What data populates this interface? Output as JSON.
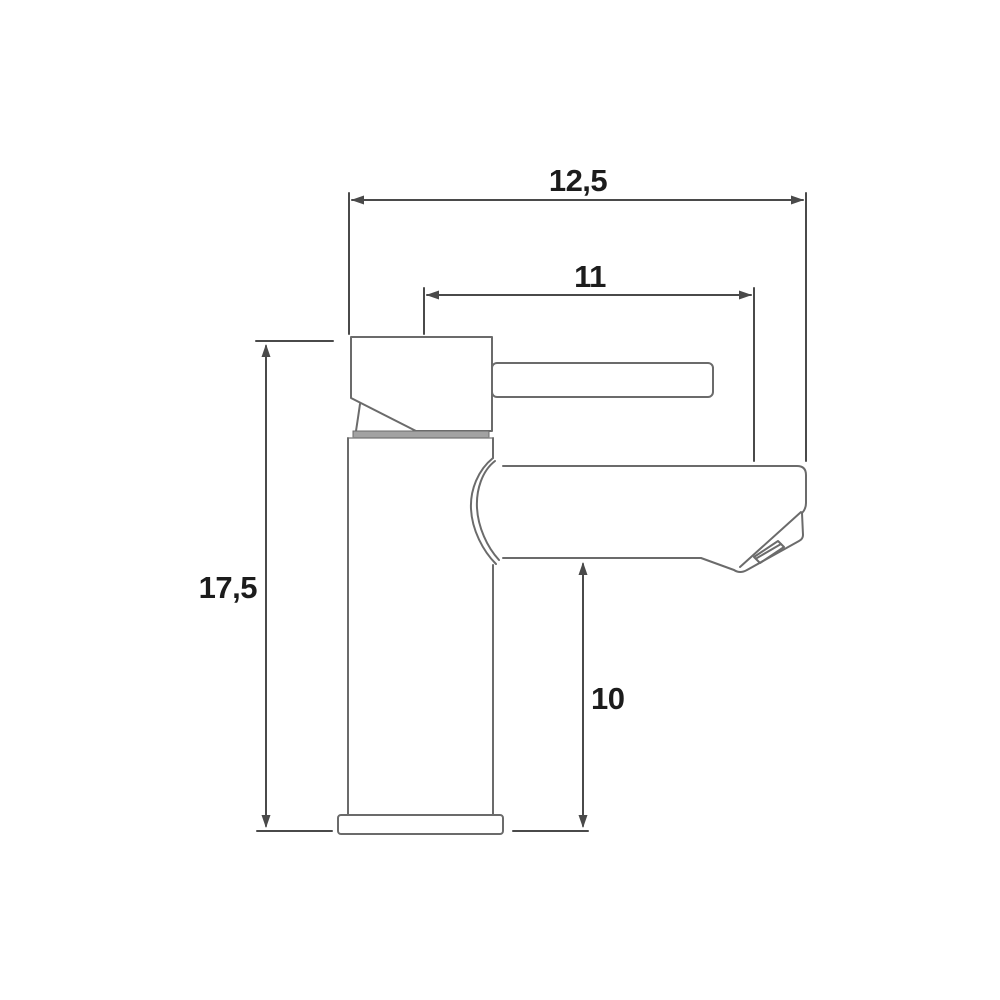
{
  "diagram": {
    "kind": "technical-dimension-drawing",
    "subject": "single-lever basin mixer tap, side view",
    "background_color": "#ffffff",
    "object_line_color": "#6b6b6b",
    "dimension_line_color": "#4a4a4a",
    "label_text_color": "#1c1c1c",
    "collar_fill_color": "#a2a2a2",
    "dimensions": {
      "overall_width": {
        "label": "12,5"
      },
      "spout_reach": {
        "label": "11"
      },
      "overall_height": {
        "label": "17,5"
      },
      "spout_height": {
        "label": "10"
      }
    }
  }
}
